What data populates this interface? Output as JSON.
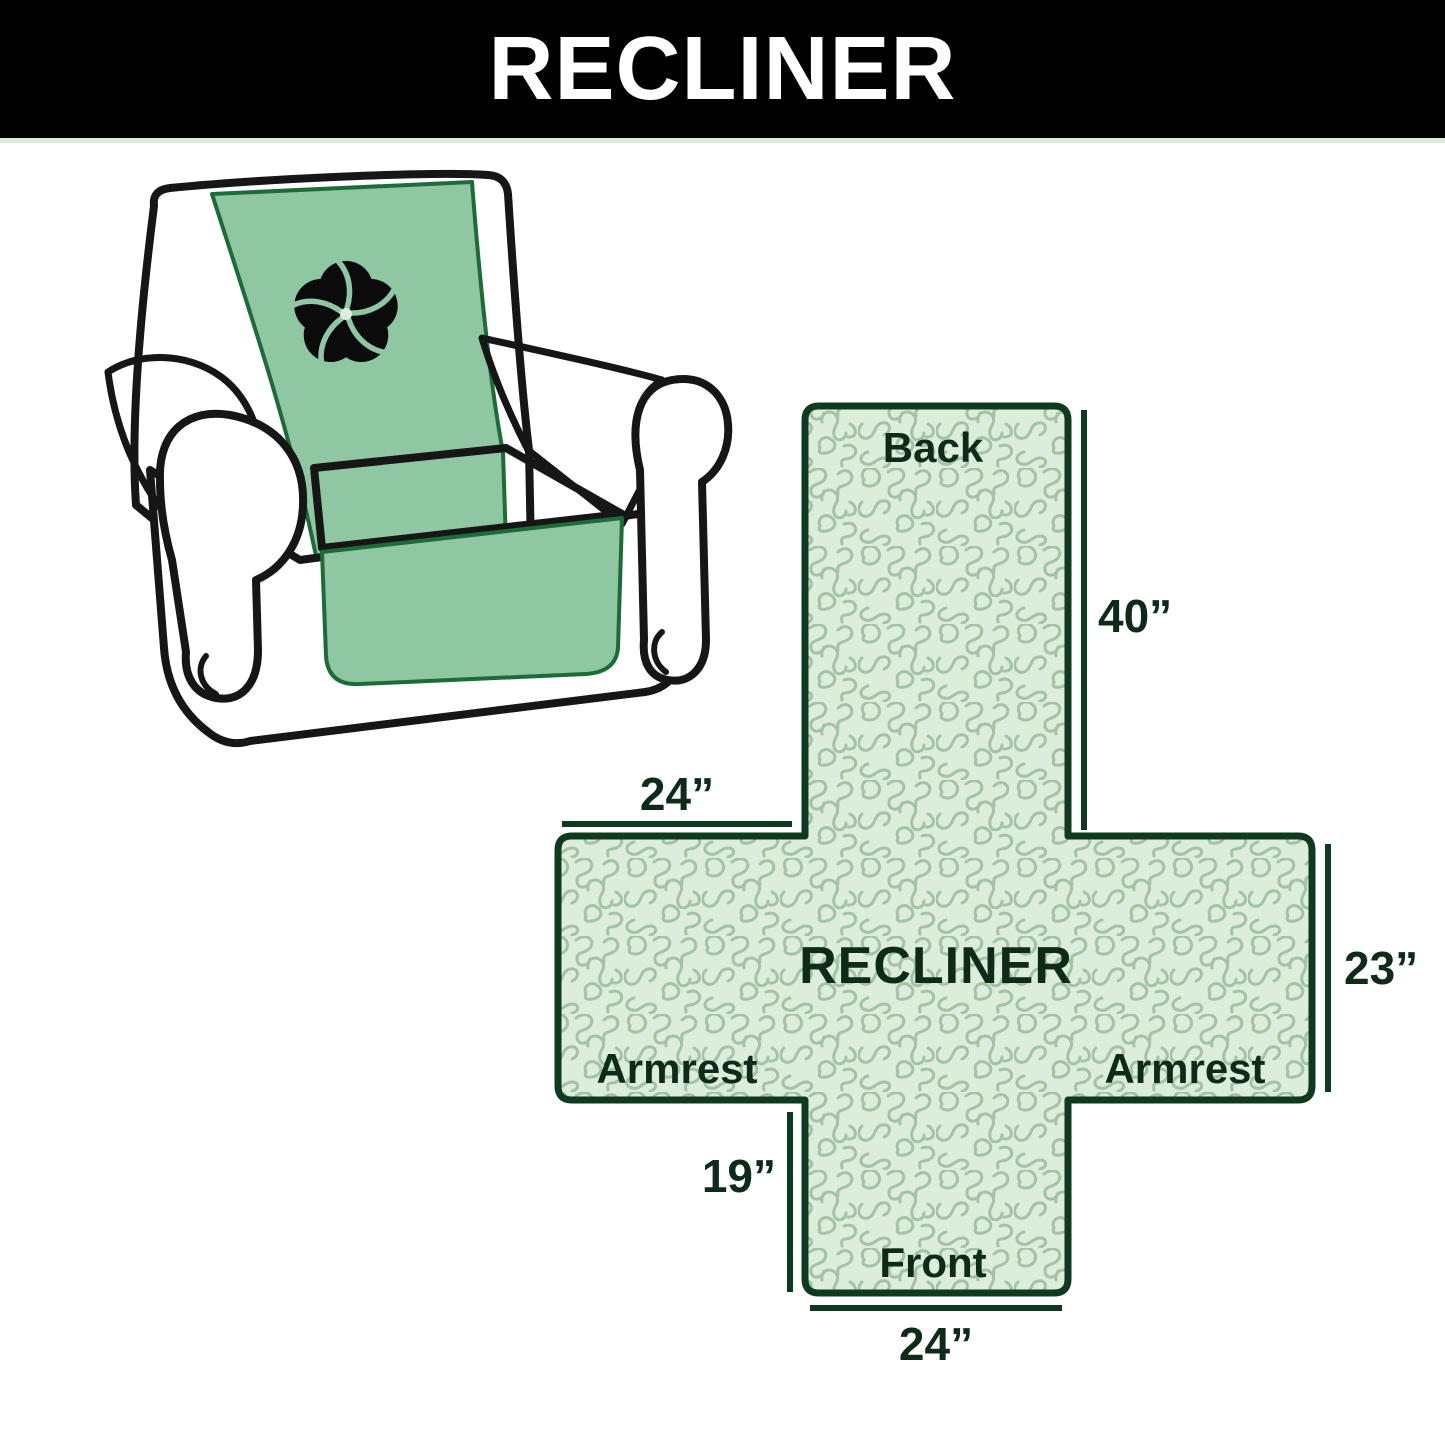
{
  "header": {
    "title": "RECLINER",
    "bg_color": "#000000",
    "text_color": "#ffffff"
  },
  "illustration": {
    "description": "armchair with protective cover",
    "cover_color": "#8ec7a2",
    "outline_color": "#161616",
    "seam_color": "#1d6b38",
    "logo_icon": "pinwheel-icon",
    "logo_color": "#0b0b0b",
    "logo_center_color": "#ddeede"
  },
  "diagram": {
    "shape": "cross-cover-layout",
    "fill_color": "#dceedb",
    "pattern_color": "#a3c2a6",
    "border_color": "#0e3a1f",
    "text_color": "#0e2b1a",
    "center_label": "RECLINER",
    "sections": {
      "back": "Back",
      "front": "Front",
      "armrest_left": "Armrest",
      "armrest_right": "Armrest"
    },
    "dimensions": {
      "back_length": "40”",
      "top_width": "24”",
      "side_width": "23”",
      "front_length": "19”",
      "bottom_width": "24”"
    }
  }
}
